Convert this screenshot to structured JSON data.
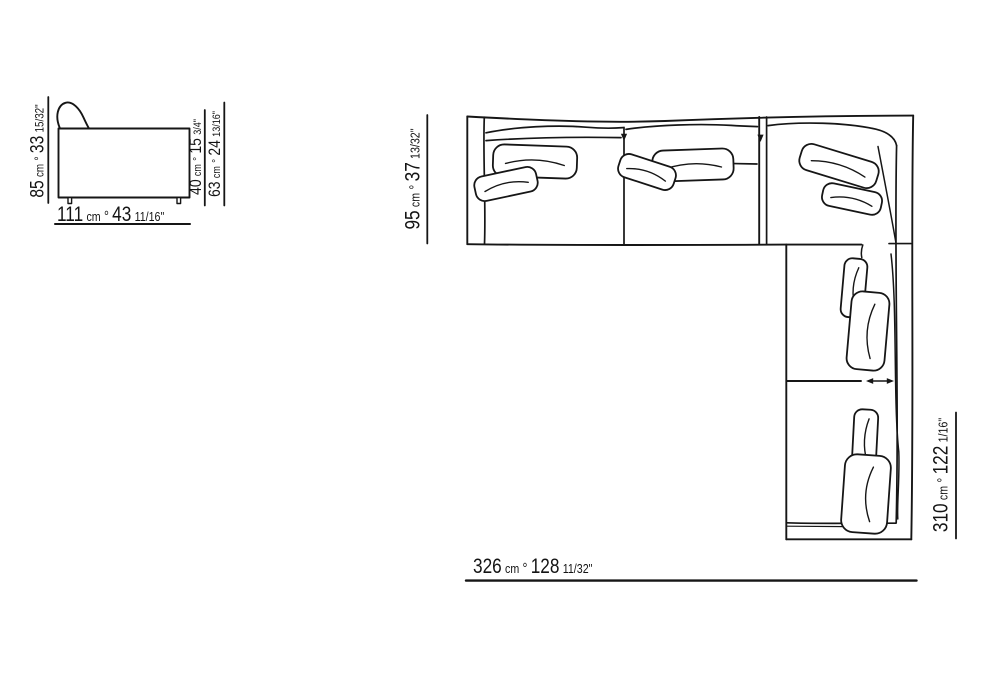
{
  "colors": {
    "background": "#ffffff",
    "ink": "#161616"
  },
  "views": {
    "elevation": {
      "name": "sofa front elevation drawing"
    },
    "plan": {
      "name": "sectional sofa plan view drawing"
    }
  },
  "dimensions": {
    "elevation_height": {
      "cm": "85",
      "unit": "cm",
      "sep": "°",
      "inches": "33",
      "fraction": "15/32\""
    },
    "elevation_seat_height": {
      "cm": "40",
      "unit": "cm",
      "sep": "°",
      "inches": "15",
      "fraction": "3/4\""
    },
    "elevation_arm_height": {
      "cm": "63",
      "unit": "cm",
      "sep": "°",
      "inches": "24",
      "fraction": "13/16\""
    },
    "elevation_width": {
      "cm": "111",
      "unit": "cm",
      "sep": "°",
      "inches": "43",
      "fraction": "11/16\""
    },
    "plan_depth": {
      "cm": "95",
      "unit": "cm",
      "sep": "°",
      "inches": "37",
      "fraction": "13/32\""
    },
    "plan_side_length": {
      "cm": "310",
      "unit": "cm",
      "sep": "°",
      "inches": "122",
      "fraction": "1/16\""
    },
    "plan_total_width": {
      "cm": "326",
      "unit": "cm",
      "sep": "°",
      "inches": "128",
      "fraction": "11/32\""
    }
  }
}
